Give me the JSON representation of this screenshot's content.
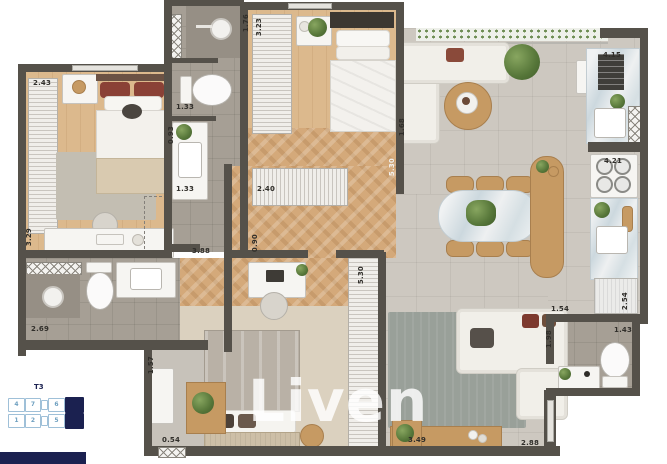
{
  "watermark": {
    "text": "Liven"
  },
  "keyplan": {
    "title": "T3",
    "row1": [
      "4",
      "7",
      "6"
    ],
    "row2": [
      "1",
      "2",
      "5"
    ]
  },
  "dimensions": [
    "2.43",
    "3.29",
    "2.69",
    "1.33",
    "0.93",
    "1.33",
    "3.88",
    "1.76",
    "3.23",
    "2.40",
    "0.90",
    "5.30",
    "1.68",
    "5.30",
    "4.15",
    "4.21",
    "2.54",
    "1.54",
    "1.43",
    "1.98",
    "1.57",
    "0.54",
    "3.49",
    "2.88"
  ],
  "colors": {
    "wall": "#55514a",
    "wood_floor": "#d4a97a",
    "tile_floor": "#a69f95",
    "concrete_floor": "#cdc8c0",
    "keyplan_navy": "#1b2150",
    "keyplan_outline": "#9fc0d8",
    "watermark": "#ffffff"
  }
}
